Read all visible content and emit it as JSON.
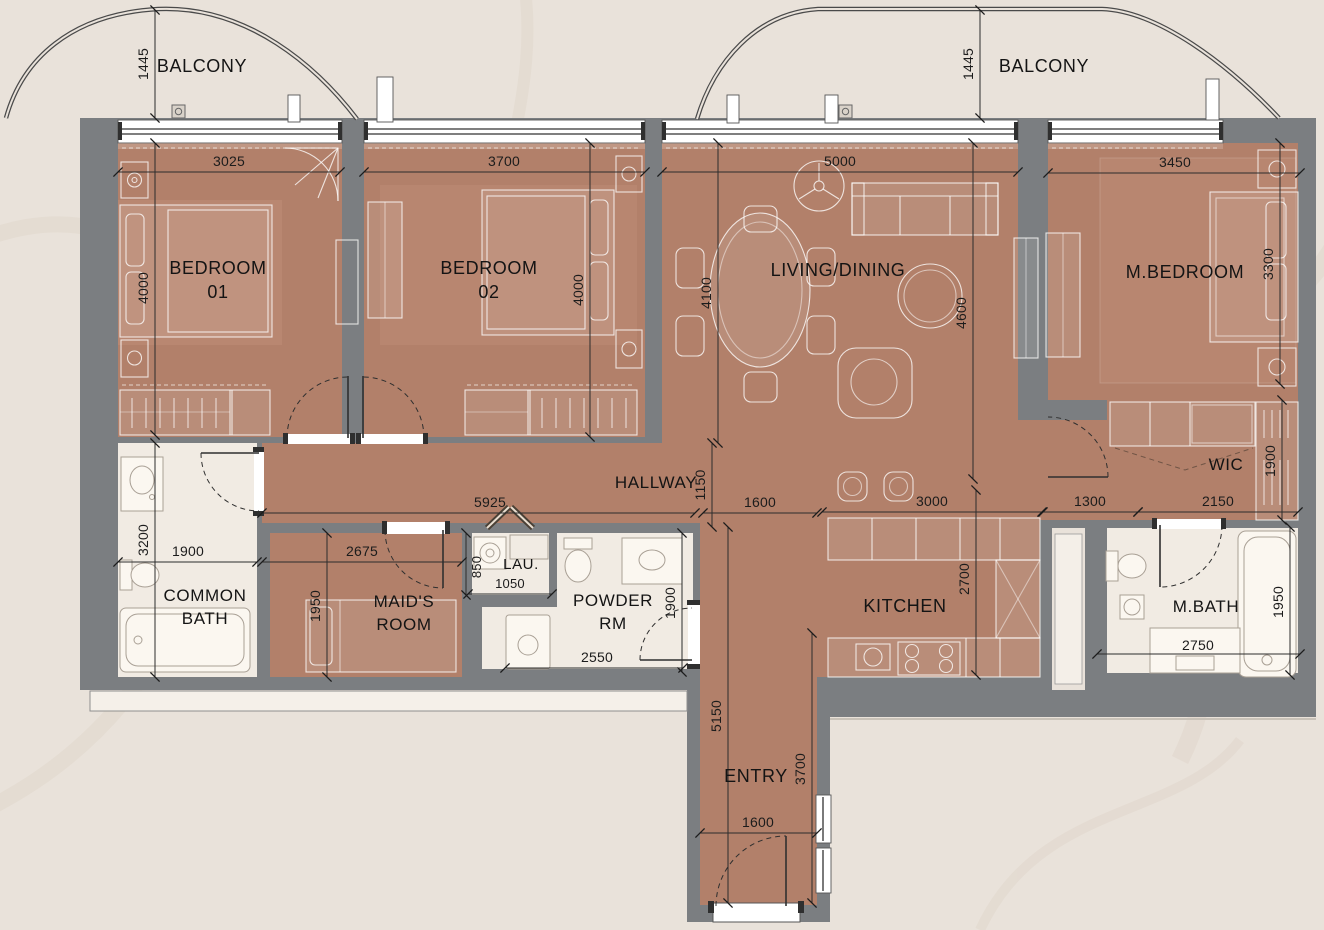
{
  "colors": {
    "background": "#e9e2da",
    "wall_gray": "#7b7e81",
    "floor_brown": "#b2806a",
    "floor_rug": "#c2917b",
    "bath_cream": "#f1ebe3",
    "ledge_light": "#f5f0e9",
    "line_dark": "#2c2c2c",
    "text": "#1a1a1a"
  },
  "balconies": {
    "left": {
      "label": "BALCONY",
      "depth": "1445"
    },
    "right": {
      "label": "BALCONY",
      "depth": "1445"
    }
  },
  "rooms": {
    "bedroom1": {
      "line1": "BEDROOM",
      "line2": "01"
    },
    "bedroom2": {
      "line1": "BEDROOM",
      "line2": "02"
    },
    "living": {
      "label": "LIVING/DINING"
    },
    "mbedroom": {
      "label": "M.BEDROOM"
    },
    "hallway": {
      "label": "HALLWAY"
    },
    "wic": {
      "label": "WIC"
    },
    "common_bath": {
      "line1": "COMMON",
      "line2": "BATH"
    },
    "maids_room": {
      "line1": "MAID'S",
      "line2": "ROOM"
    },
    "laundry": {
      "label": "LAU."
    },
    "powder": {
      "line1": "POWDER",
      "line2": "RM"
    },
    "kitchen": {
      "label": "KITCHEN"
    },
    "mbath": {
      "label": "M.BATH"
    },
    "entry": {
      "label": "ENTRY"
    }
  },
  "dims": {
    "balcony_left_depth": "1445",
    "balcony_right_depth": "1445",
    "bed1_w": "3025",
    "bed1_h": "4000",
    "bed2_w": "3700",
    "bed2_h": "4000",
    "living_w": "5000",
    "living_h": "4600",
    "dining_h": "4100",
    "mbed_w": "3450",
    "mbed_h": "3300",
    "hall_len": "5925",
    "hall_h": "1150",
    "hall_right": "1600",
    "kitchen_w": "3000",
    "kitchen_h": "2700",
    "suite_pass": "1300",
    "wic_w": "2150",
    "wic_h": "1900",
    "cbath_w": "1900",
    "cbath_h": "3200",
    "maid_w": "2675",
    "maid_h": "1950",
    "lau_w": "1050",
    "lau_d": "850",
    "powder_w": "2550",
    "powder_h": "1900",
    "mbath_w": "2750",
    "mbath_h": "1950",
    "entry_len": "5150",
    "entry_h": "3700",
    "entry_w": "1600"
  }
}
